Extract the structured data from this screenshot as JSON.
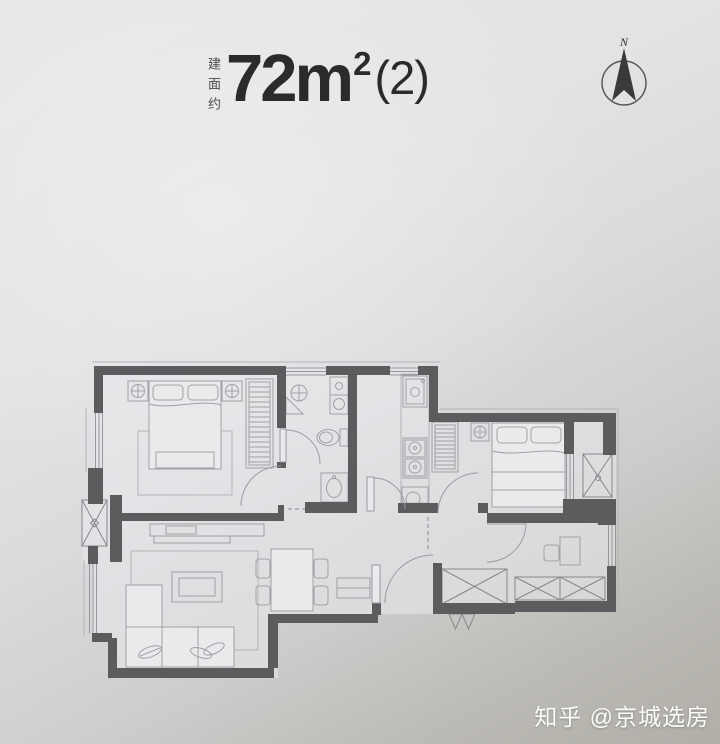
{
  "header": {
    "area_prefix_vertical": "建面约",
    "area_value": "72m",
    "area_superscript": "2",
    "area_suffix": "(2)"
  },
  "compass": {
    "north_label": "N"
  },
  "watermark": {
    "text": "知乎 @京城选房"
  },
  "palette": {
    "wall": "#5c5c5f",
    "furniture_line": "#a1a1a5",
    "window_line": "#97979b",
    "door_line": "#9b9ba0",
    "room_fill": "#e9eaec",
    "title_text": "#2b2b2d",
    "label_text": "#4a4a4c",
    "watermark_text": "#fbfbf9",
    "background_top": "#e8e8ea",
    "background_bottom": "#b0aea7"
  }
}
